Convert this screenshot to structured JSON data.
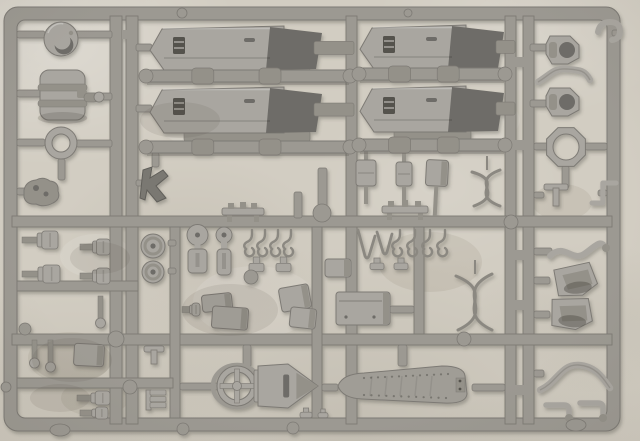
{
  "photo": {
    "width": 640,
    "height": 441,
    "subject": "unpainted grey injection-molded model kit sprue photographed on a light mottled surface"
  },
  "sprue": {
    "colors": {
      "runner": "#9c9992",
      "edge": "#7d7a74",
      "light": "#a9a6a0",
      "mid": "#949189",
      "dark": "#6e6c67",
      "darkest": "#55534e",
      "wire": "#8b8881",
      "shade": "rgba(60,57,50,0.18)",
      "track": "#a09d96",
      "rivet": "#78766f",
      "kfill": "#7a7872",
      "kedge": "#615f5a"
    },
    "frame": {
      "outer": [
        4,
        7,
        616,
        424,
        14
      ],
      "inner": [
        17,
        20,
        590,
        398,
        8
      ]
    },
    "runners": [
      [
        110,
        16,
        12,
        408
      ],
      [
        126,
        16,
        12,
        408
      ],
      [
        346,
        16,
        11,
        408
      ],
      [
        505,
        16,
        11,
        408
      ],
      [
        523,
        16,
        11,
        408
      ],
      [
        12,
        216,
        600,
        11
      ],
      [
        12,
        334,
        600,
        11
      ],
      [
        170,
        227,
        10,
        191
      ],
      [
        312,
        227,
        10,
        191
      ],
      [
        414,
        227,
        10,
        107
      ],
      [
        17,
        281,
        121,
        10
      ],
      [
        17,
        378,
        156,
        10
      ]
    ],
    "ties": [
      [
        515,
        57,
        9,
        10
      ],
      [
        515,
        140,
        9,
        10
      ],
      [
        515,
        250,
        9,
        10
      ],
      [
        515,
        300,
        9,
        10
      ],
      [
        515,
        385,
        9,
        10
      ],
      [
        122,
        30,
        5,
        9
      ]
    ],
    "stubs": [
      [
        17,
        31,
        28,
        7
      ],
      [
        76,
        31,
        36,
        7
      ],
      [
        17,
        90,
        24,
        7
      ],
      [
        83,
        93,
        29,
        7
      ],
      [
        17,
        139,
        28,
        7
      ],
      [
        76,
        140,
        36,
        7
      ],
      [
        17,
        188,
        10,
        7
      ],
      [
        58,
        159,
        7,
        21
      ],
      [
        136,
        44,
        16,
        7
      ],
      [
        136,
        105,
        16,
        7
      ],
      [
        530,
        44,
        17,
        7
      ],
      [
        530,
        100,
        17,
        7
      ],
      [
        534,
        143,
        16,
        7
      ],
      [
        585,
        143,
        22,
        7
      ],
      [
        562,
        166,
        7,
        22
      ],
      [
        534,
        192,
        10,
        6
      ],
      [
        598,
        190,
        9,
        6
      ],
      [
        534,
        248,
        18,
        7
      ],
      [
        534,
        277,
        16,
        7
      ],
      [
        534,
        311,
        16,
        7
      ],
      [
        534,
        370,
        10,
        7
      ],
      [
        318,
        168,
        9,
        50
      ],
      [
        294,
        192,
        8,
        26
      ],
      [
        168,
        240,
        8,
        6
      ],
      [
        168,
        268,
        8,
        6
      ],
      [
        180,
        383,
        38,
        7
      ],
      [
        322,
        384,
        16,
        7
      ],
      [
        472,
        384,
        33,
        7
      ],
      [
        398,
        345,
        9,
        21
      ],
      [
        243,
        345,
        8,
        22
      ],
      [
        390,
        306,
        24,
        7
      ],
      [
        152,
        153,
        7,
        14
      ],
      [
        136,
        180,
        8,
        6
      ],
      [
        612,
        30,
        8,
        6
      ]
    ],
    "bars": [
      [
        143,
        70,
        210,
        12
      ],
      [
        143,
        141,
        210,
        12
      ],
      [
        356,
        68,
        152,
        12
      ],
      [
        356,
        139,
        152,
        12
      ]
    ],
    "pads": [
      [
        182,
        13,
        5
      ],
      [
        408,
        13,
        4
      ],
      [
        116,
        339,
        8
      ],
      [
        130,
        387,
        7
      ],
      [
        322,
        213,
        9
      ],
      [
        511,
        222,
        7
      ],
      [
        6,
        387,
        5
      ],
      [
        25,
        329,
        6
      ],
      [
        183,
        429,
        6
      ],
      [
        293,
        428,
        6
      ],
      [
        464,
        339,
        7
      ],
      [
        251,
        277,
        7
      ]
    ],
    "oval_pads": [
      [
        60,
        430,
        10,
        6
      ],
      [
        576,
        425,
        10,
        6
      ]
    ],
    "stains": [
      [
        70,
        358,
        42,
        26
      ],
      [
        255,
        302,
        62,
        36
      ],
      [
        430,
        262,
        52,
        30
      ],
      [
        96,
        256,
        36,
        22
      ],
      [
        562,
        202,
        30,
        18
      ],
      [
        210,
        122,
        52,
        26
      ],
      [
        95,
        398,
        34,
        18
      ],
      [
        480,
        120,
        40,
        22
      ]
    ],
    "parts": [
      {
        "id": "cupola",
        "type": "cup",
        "cx": 61,
        "cy": 39,
        "r": 17
      },
      {
        "id": "exhaust-drum",
        "type": "drum",
        "x": 40,
        "y": 70,
        "w": 45,
        "h": 50
      },
      {
        "id": "hatch-ring",
        "type": "ring",
        "cx": 61,
        "cy": 143,
        "ro": 16,
        "ri": 9
      },
      {
        "id": "small-lump",
        "type": "blob",
        "x": 24,
        "y": 178
      },
      {
        "id": "hull-plate-1",
        "type": "hullplate",
        "x": 150,
        "y": 26,
        "w": 196,
        "h": 44,
        "bw": 120
      },
      {
        "id": "hull-plate-2",
        "type": "hullplate",
        "x": 150,
        "y": 87,
        "w": 196,
        "h": 46,
        "bw": 120
      },
      {
        "id": "hull-plate-3",
        "type": "hullplate",
        "x": 360,
        "y": 25,
        "w": 147,
        "h": 44,
        "bw": 92
      },
      {
        "id": "hull-plate-4",
        "type": "hullplate",
        "x": 360,
        "y": 86,
        "w": 147,
        "h": 46,
        "bw": 92
      },
      {
        "id": "corner-hook",
        "type": "cornerhook",
        "x": 598,
        "y": 20
      },
      {
        "id": "fender-hook-1",
        "type": "fenderhook",
        "x": 546,
        "y": 36
      },
      {
        "id": "curved-strip",
        "type": "strip",
        "x": 538,
        "y": 64,
        "w": 52,
        "h": 24
      },
      {
        "id": "fender-hook-2",
        "type": "fenderhook",
        "x": 546,
        "y": 88
      },
      {
        "id": "octagon-ring",
        "type": "octring",
        "cx": 566,
        "cy": 147,
        "ro": 21,
        "ri": 13
      },
      {
        "id": "t-bracket-r",
        "type": "bracket",
        "variant": "T",
        "x": 544,
        "y": 184,
        "w": 24,
        "h": 22
      },
      {
        "id": "z-bracket-r",
        "type": "bracket",
        "variant": "Z",
        "x": 592,
        "y": 180,
        "w": 24,
        "h": 26
      },
      {
        "id": "bolt-1",
        "type": "bolt",
        "x": 22,
        "y": 231,
        "w": 36,
        "h": 18
      },
      {
        "id": "bolt-2",
        "type": "bolt",
        "x": 80,
        "y": 239,
        "w": 30,
        "h": 16
      },
      {
        "id": "bolt-3",
        "type": "bolt",
        "x": 22,
        "y": 265,
        "w": 38,
        "h": 18
      },
      {
        "id": "bolt-4",
        "type": "bolt",
        "x": 80,
        "y": 268,
        "w": 30,
        "h": 16
      },
      {
        "id": "pin-1",
        "type": "pin",
        "x": 98,
        "y": 296,
        "len": 24
      },
      {
        "id": "road-wheel-1",
        "type": "wheel",
        "cx": 153,
        "cy": 246,
        "r": 12
      },
      {
        "id": "road-wheel-2",
        "type": "wheel",
        "cx": 153,
        "cy": 272,
        "r": 11
      },
      {
        "id": "lever-1",
        "type": "lever",
        "x": 188,
        "y": 229,
        "w": 19,
        "h": 44
      },
      {
        "id": "lever-2",
        "type": "lever",
        "x": 217,
        "y": 229,
        "w": 14,
        "h": 46
      },
      {
        "id": "spring-hooks-1",
        "type": "hookrow",
        "x": 252,
        "y": 230,
        "n": 4,
        "sp": 13,
        "hh": 20
      },
      {
        "id": "cap-1",
        "type": "cap",
        "x": 249,
        "y": 257,
        "w": 15,
        "h": 15
      },
      {
        "id": "cap-2",
        "type": "cap",
        "x": 276,
        "y": 257,
        "w": 15,
        "h": 15
      },
      {
        "id": "plug-bolt",
        "type": "bolt",
        "x": 182,
        "y": 303,
        "w": 18,
        "h": 13
      },
      {
        "id": "box-1",
        "type": "box",
        "x": 202,
        "y": 294,
        "w": 30,
        "h": 17,
        "rot": -6
      },
      {
        "id": "box-2",
        "type": "box",
        "x": 212,
        "y": 307,
        "w": 36,
        "h": 22,
        "rot": 4
      },
      {
        "id": "box-3",
        "type": "box",
        "x": 280,
        "y": 286,
        "w": 30,
        "h": 24,
        "rot": -10
      },
      {
        "id": "box-4",
        "type": "box",
        "x": 290,
        "y": 308,
        "w": 26,
        "h": 20,
        "rot": 6
      },
      {
        "id": "k-part",
        "type": "kpart",
        "x": 143,
        "y": 167
      },
      {
        "id": "bench-1",
        "type": "bench",
        "x": 222,
        "y": 201,
        "w": 42,
        "h": 16
      },
      {
        "id": "damper-1",
        "type": "damper",
        "x": 356,
        "y": 160,
        "w": 20,
        "bh": 26,
        "rod": 18
      },
      {
        "id": "damper-2",
        "type": "damper",
        "x": 396,
        "y": 162,
        "w": 16,
        "bh": 24,
        "rod": 16
      },
      {
        "id": "box-5",
        "type": "box",
        "x": 426,
        "y": 160,
        "w": 22,
        "h": 26,
        "rot": 3,
        "rod": 30
      },
      {
        "id": "bench-2",
        "type": "bench",
        "x": 382,
        "y": 201,
        "w": 46,
        "h": 14
      },
      {
        "id": "tow-wire-1",
        "type": "wire8",
        "x": 468,
        "y": 168,
        "w": 38,
        "h": 40
      },
      {
        "id": "spring-hooks-2",
        "type": "hookrow",
        "x": 400,
        "y": 230,
        "n": 4,
        "sp": 15,
        "hh": 24
      },
      {
        "id": "wire-loop",
        "type": "wirev",
        "x": 356,
        "y": 230,
        "w": 36,
        "h": 30
      },
      {
        "id": "cap-3",
        "type": "cap",
        "x": 370,
        "y": 258,
        "w": 14,
        "h": 12
      },
      {
        "id": "cap-4",
        "type": "cap",
        "x": 394,
        "y": 258,
        "w": 14,
        "h": 12
      },
      {
        "id": "box-6",
        "type": "box",
        "x": 325,
        "y": 259,
        "w": 26,
        "h": 18,
        "rot": 0
      },
      {
        "id": "fuel-tank",
        "type": "box",
        "x": 336,
        "y": 292,
        "w": 54,
        "h": 33,
        "rot": 0,
        "lid": true
      },
      {
        "id": "tow-wire-2",
        "type": "wire8",
        "x": 452,
        "y": 272,
        "w": 46,
        "h": 60
      },
      {
        "id": "s-arm",
        "type": "sarm",
        "x": 550,
        "y": 240
      },
      {
        "id": "scoop-1",
        "type": "scoop",
        "x": 551,
        "y": 264,
        "rot": -6
      },
      {
        "id": "scoop-2",
        "type": "scoop",
        "x": 547,
        "y": 297,
        "rot": 5
      },
      {
        "id": "pin-2",
        "type": "pin",
        "x": 32,
        "y": 340,
        "len": 20
      },
      {
        "id": "pin-3",
        "type": "pin",
        "x": 48,
        "y": 340,
        "len": 24
      },
      {
        "id": "box-7",
        "type": "box",
        "x": 74,
        "y": 344,
        "w": 30,
        "h": 22,
        "rot": 3
      },
      {
        "id": "bolt-5",
        "type": "bolt",
        "x": 77,
        "y": 391,
        "w": 33,
        "h": 14
      },
      {
        "id": "bolt-6",
        "type": "bolt",
        "x": 80,
        "y": 407,
        "w": 28,
        "h": 12
      },
      {
        "id": "t-bracket-l",
        "type": "bracket",
        "variant": "T",
        "x": 144,
        "y": 346,
        "w": 20,
        "h": 18
      },
      {
        "id": "e-bracket-l",
        "type": "bracket",
        "variant": "E",
        "x": 146,
        "y": 390,
        "w": 22,
        "h": 20
      },
      {
        "id": "gun-wheel",
        "type": "wheelcross",
        "cx": 237,
        "cy": 386,
        "ro": 20,
        "ri": 14
      },
      {
        "id": "gun-carriage",
        "type": "carriage",
        "x": 258,
        "y": 364,
        "w": 60,
        "h": 44
      },
      {
        "id": "track-run",
        "type": "trackrun",
        "x": 338,
        "y": 366,
        "w": 134,
        "h": 40
      },
      {
        "id": "s-strip",
        "type": "strip",
        "x": 540,
        "y": 360,
        "w": 70,
        "h": 36
      },
      {
        "id": "elbow-1",
        "type": "elbow",
        "x": 546,
        "y": 402,
        "w": 26,
        "h": 16
      },
      {
        "id": "elbow-2",
        "type": "elbow",
        "x": 580,
        "y": 400,
        "w": 26,
        "h": 18
      },
      {
        "id": "nub-1",
        "type": "cap",
        "x": 300,
        "y": 408,
        "w": 12,
        "h": 10
      },
      {
        "id": "nub-2",
        "type": "cap",
        "x": 318,
        "y": 409,
        "w": 10,
        "h": 9
      }
    ]
  }
}
